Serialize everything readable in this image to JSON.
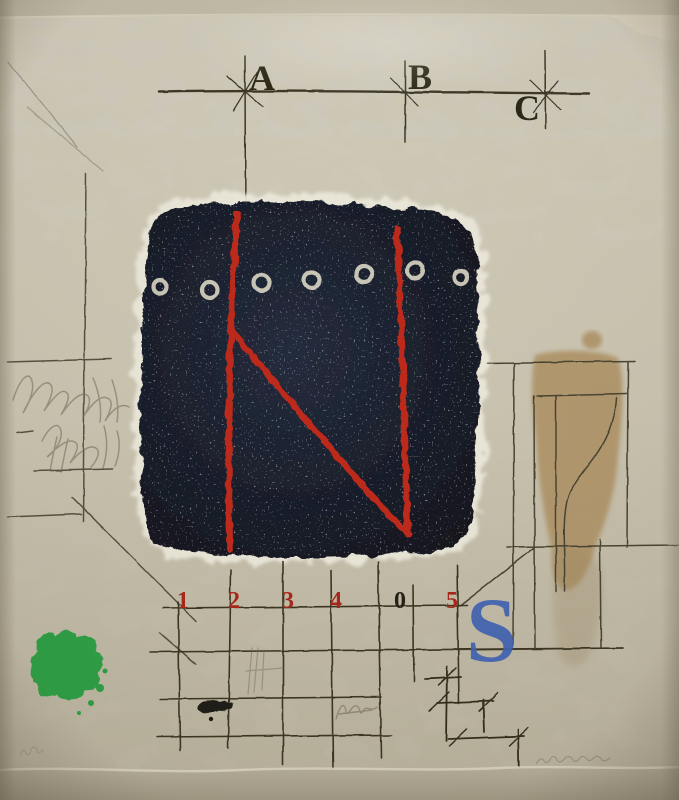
{
  "artwork": {
    "description": "photograph of an abstract mixed-media print on paper",
    "top_letters": [
      "A",
      "B",
      "C"
    ],
    "scale_numbers": [
      "1",
      "2",
      "3",
      "4",
      "0",
      "5"
    ],
    "number_colors": [
      "#a9271a",
      "#a9271a",
      "#a9271a",
      "#a9271a",
      "#232015",
      "#a9271a"
    ],
    "blue_letter": "S",
    "marks": {
      "signature": "illegible-pencil-signature",
      "edition": "illegible-pencil-edition-mark"
    }
  },
  "colors": {
    "paper_light": "#d3cdbb",
    "paper": "#cbc5b2",
    "paper_dark": "#b9b29d",
    "texture_spot": "#a49c84",
    "square_navy": "#11141d",
    "square_navy_light": "#242c3d",
    "square_halo": "#e7e3d4",
    "ring_white": "#d8d4c4",
    "red_line": "#be2a1b",
    "letter_dark": "#2c2817",
    "blue_s": "#4063b4",
    "green_blob": "#2d9f45",
    "tan_wash": "#ad8e5f",
    "pencil": "#4a4534",
    "ink_blob": "#1b1b12"
  }
}
